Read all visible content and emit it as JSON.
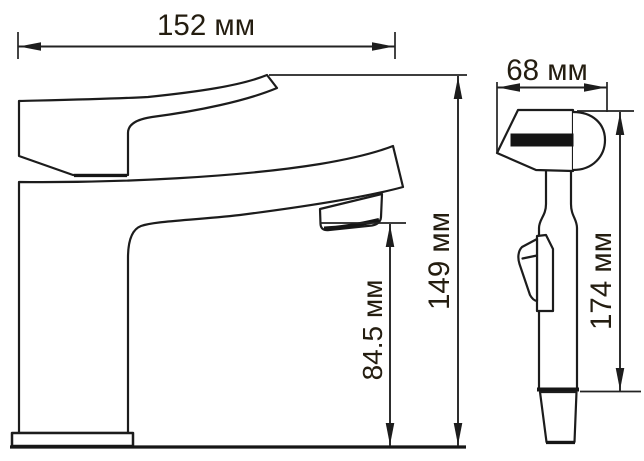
{
  "drawing": {
    "type": "faucet dimensional technical drawing, two orthographic views",
    "colors": {
      "background": "#ffffff",
      "line": "#1c1c1c",
      "label_text": "#241d10",
      "handle_band": "#141414"
    }
  },
  "dimensions": {
    "front_width": {
      "value": 152,
      "unit": "мм",
      "label": "152 мм"
    },
    "front_total_height": {
      "value": 149,
      "unit": "мм",
      "label": "149 мм"
    },
    "front_spout_height": {
      "value": 84.5,
      "unit": "мм",
      "label": "84.5 мм"
    },
    "side_depth": {
      "value": 68,
      "unit": "мм",
      "label": "68 мм"
    },
    "side_height": {
      "value": 174,
      "unit": "мм",
      "label": "174 мм"
    }
  }
}
